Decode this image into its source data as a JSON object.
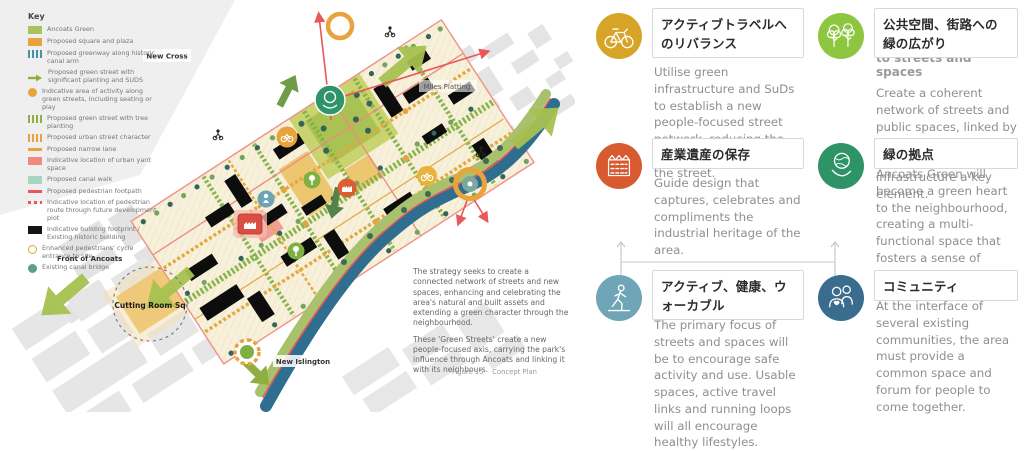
{
  "map": {
    "key": {
      "title": "Key",
      "items": [
        {
          "swatch": "solid",
          "color": "#a9c25d",
          "label": "Ancoats Green"
        },
        {
          "swatch": "solid",
          "color": "#e8a33d",
          "label": "Proposed square and plaza"
        },
        {
          "swatch": "stripes",
          "color": "#4a8fa8",
          "label": "Proposed greenway along historic canal arm"
        },
        {
          "swatch": "arrow",
          "color": "#8faf3e",
          "label": "Proposed green street with significant planting and SUDS"
        },
        {
          "swatch": "dot",
          "color": "#e8a33d",
          "label": "Indicative area of activity along green streets, including seating or play"
        },
        {
          "swatch": "stripes",
          "color": "#8faf3e",
          "label": "Proposed green street with tree planting"
        },
        {
          "swatch": "stripes",
          "color": "#e8a33d",
          "label": "Proposed urban street character"
        },
        {
          "swatch": "line",
          "color": "#e8a33d",
          "label": "Proposed narrow lane"
        },
        {
          "swatch": "solid",
          "color": "#ef8a80",
          "label": "Indicative location of urban yard space"
        },
        {
          "swatch": "solid",
          "color": "#a8d5c2",
          "label": "Proposed canal walk"
        },
        {
          "swatch": "line",
          "color": "#e8575a",
          "label": "Proposed pedestrian footpath"
        },
        {
          "swatch": "dashes",
          "color": "#e8575a",
          "label": "Indicative location of pedestrian route through future development plot"
        },
        {
          "swatch": "solid",
          "color": "#141414",
          "label": "Indicative building footprint / Existing historic building"
        },
        {
          "swatch": "ring",
          "color": "#e8a33d",
          "label": "Enhanced pedestrians' cycle entrance to site"
        },
        {
          "swatch": "dot",
          "color": "#5a9e8f",
          "label": "Existing canal bridge"
        }
      ]
    },
    "labels": {
      "new_cross": "New Cross",
      "miles_platting": "Miles Platting",
      "front_of_ancoats": "Front of Ancoats",
      "cutting_room_sq": "Cutting Room Sq",
      "new_islington": "New Islington"
    },
    "strategy": [
      "The strategy seeks to create a connected network of streets and new spaces, enhancing and celebrating the area's natural and built assets and extending a green character through the neighbourhood.",
      "These 'Green Streets' create a new people-focused axis, carrying the park's influence through Ancoats and linking it with its neighbours."
    ],
    "figure_caption": "Figure 15    Concept Plan"
  },
  "principles": [
    {
      "id": "active-travel",
      "icon": "bicycle",
      "color": "#d6a427",
      "title": "アクティブトラベルへのリバランス",
      "body": "Utilise green infrastructure and SuDs to establish a new people-focused street network, reducing the dominance of vehicles in the street."
    },
    {
      "id": "green-streets",
      "icon": "trees",
      "color": "#8dc63f",
      "title": "公共空間、街路への緑の広がり",
      "remnant": "to streets and spaces",
      "body": "Create a coherent network of streets and public spaces, linked by a common design language, with green infrastructure a key element."
    },
    {
      "id": "heritage",
      "icon": "factory",
      "color": "#d85b30",
      "title": "産業遺産の保存",
      "body": "Guide design that captures, celebrates and compliments the industrial heritage of the area."
    },
    {
      "id": "green-heart",
      "icon": "hand-globe",
      "color": "#2e9467",
      "body_overlap": true,
      "title": "緑の拠点",
      "body": "Ancoats Green will become a green heart to the neighbourhood, creating a multi-functional space that fosters a sense of community."
    },
    {
      "id": "active-healthy",
      "icon": "walking",
      "color": "#6fa5b6",
      "body_overlap": true,
      "title": "アクティブ、健康、ウォーカブル",
      "body": "The primary focus of streets and spaces will be to encourage safe activity and use. Usable spaces, active travel links and running loops will all encourage healthy lifestyles."
    },
    {
      "id": "community",
      "icon": "people",
      "color": "#3a6d8d",
      "body_overlap": true,
      "title": "コミュニティ",
      "body": "At the interface of several existing communities, the area must provide a common space and forum for people to come together."
    }
  ]
}
